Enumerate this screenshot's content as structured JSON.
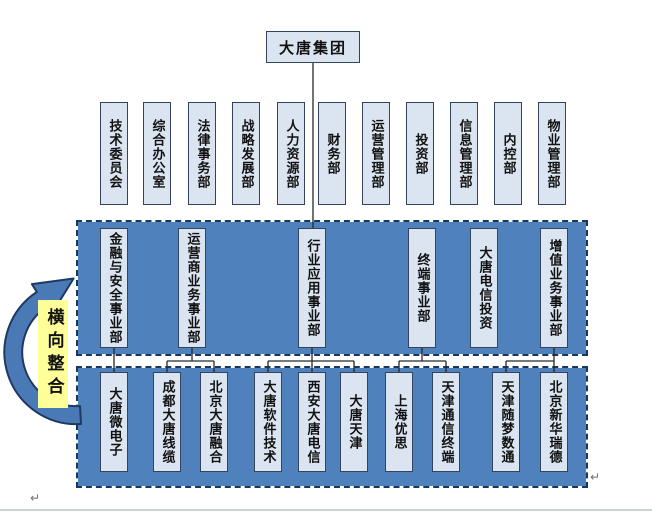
{
  "root": {
    "label": "大唐集团"
  },
  "departments": [
    "技术委员会",
    "综合办公室",
    "法律事务部",
    "战略发展部",
    "人力资源部",
    "财务部",
    "运营管理部",
    "投资部",
    "信息管理部",
    "内控部",
    "物业管理部"
  ],
  "divisions": [
    "金融与安全事业部",
    "运营商业务事业部",
    "行业应用事业部",
    "终端事业部",
    "大唐电信投资",
    "增值业务事业部"
  ],
  "subsidiaries": [
    "大唐微电子",
    "成都大唐线缆",
    "北京大唐融合",
    "大唐软件技术",
    "西安大唐电信",
    "大唐天津",
    "上海优思",
    "天津通信终端",
    "天津随梦数通",
    "北京新华瑞德"
  ],
  "arrow_label": "横向整合",
  "paragraph_mark": "↵",
  "colors": {
    "panel_blue": "#4f81bd",
    "box_fill": "#dbe5f1",
    "label_yellow": "#ffff99",
    "dash_border": "#17375e"
  }
}
